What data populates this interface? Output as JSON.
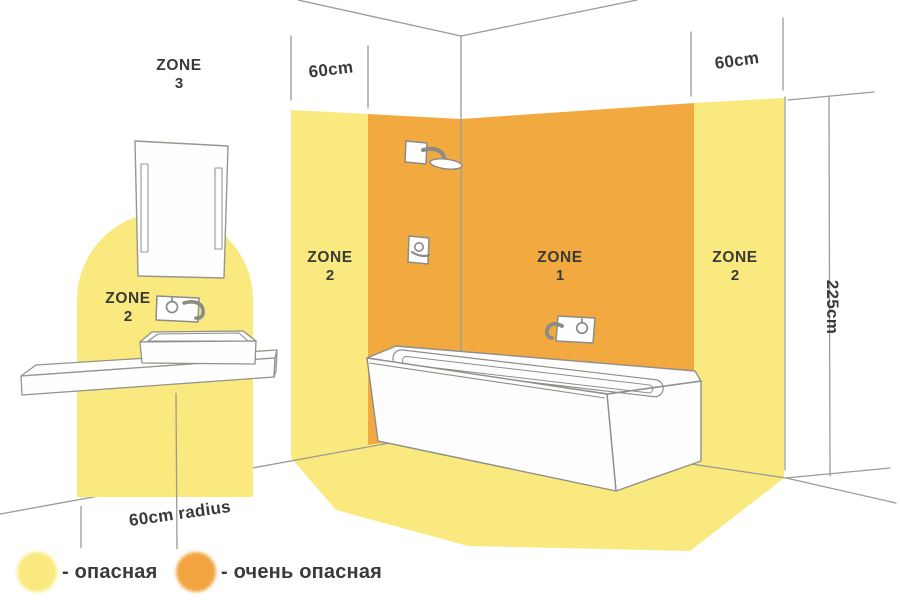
{
  "colors": {
    "background": "#FFFFFF",
    "zone_dangerous_yellow": "#F9E97E",
    "zone_very_dangerous_orange": "#F2A940",
    "outline_gray": "#9B9B93",
    "fixture_gray": "#8C8C86",
    "text_dark": "#3A3A38"
  },
  "zone_labels": {
    "zone3": {
      "word": "ZONE",
      "number": "3"
    },
    "zone2_left_wall": {
      "word": "ZONE",
      "number": "2"
    },
    "zone1_back_wall": {
      "word": "ZONE",
      "number": "1"
    },
    "zone2_right_wall": {
      "word": "ZONE",
      "number": "2"
    },
    "zone2_washbasin": {
      "word": "ZONE",
      "number": "2"
    }
  },
  "measurements": {
    "left_wall_band_width": "60cm",
    "right_wall_band_width": "60cm",
    "zone_height": "225cm",
    "washbasin_radius": "60cm radius"
  },
  "legend": {
    "items": [
      {
        "label": "- опасная",
        "color": "#F9E97E"
      },
      {
        "label": "- очень опасная",
        "color": "#F2A441"
      }
    ]
  }
}
